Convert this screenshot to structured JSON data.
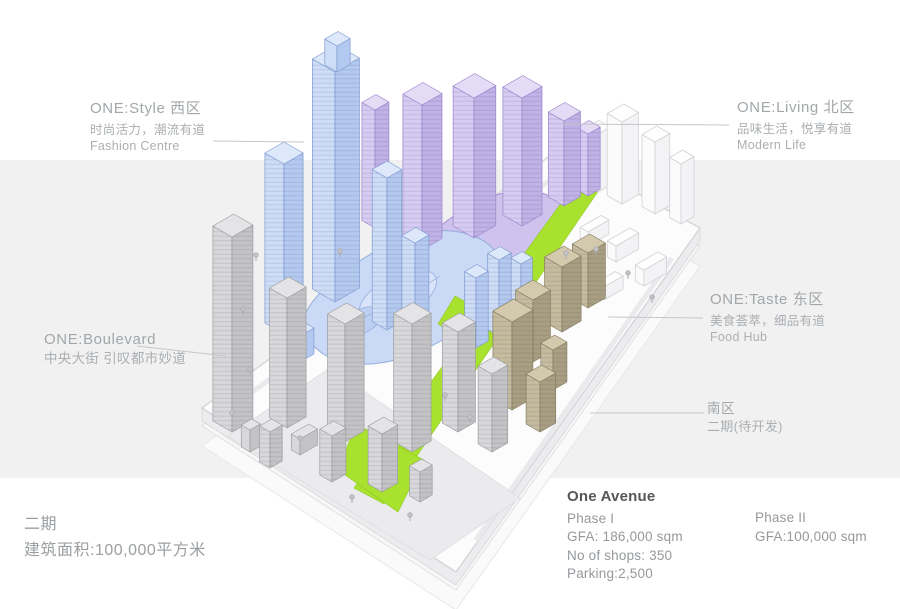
{
  "labels": {
    "west": {
      "title": "ONE:Style 西区",
      "subtitle_cn": "时尚活力，潮流有道",
      "subtitle_en": "Fashion Centre"
    },
    "north": {
      "title": "ONE:Living 北区",
      "subtitle_cn": "品味生活，悦享有道",
      "subtitle_en": "Modern Life"
    },
    "east": {
      "title": "ONE:Taste 东区",
      "subtitle_cn": "美食荟萃，细品有道",
      "subtitle_en": "Food Hub"
    },
    "south": {
      "title": "南区",
      "subtitle_cn": "二期(待开发)"
    },
    "boulevard": {
      "title": "ONE:Boulevard",
      "subtitle_cn": "中央大街 引叹都市妙道"
    }
  },
  "phase2_note": {
    "line1": "二期",
    "line2": "建筑面积:100,000平方米"
  },
  "stats": {
    "title": "One Avenue",
    "phase1": {
      "name": "Phase I",
      "gfa": "GFA: 186,000 sqm",
      "shops": "No of shops: 350",
      "parking": "Parking:2,500"
    },
    "phase2": {
      "name": "Phase II",
      "gfa": "GFA:100,000 sqm"
    }
  },
  "colors": {
    "west_blue": "#b4c9ef",
    "north_purple": "#c0b1e6",
    "avenue_green": "#a9e12f",
    "east_tan": "#a89e81",
    "south_gray": "#c3c3c5",
    "background_band": "#f1f1f2"
  }
}
